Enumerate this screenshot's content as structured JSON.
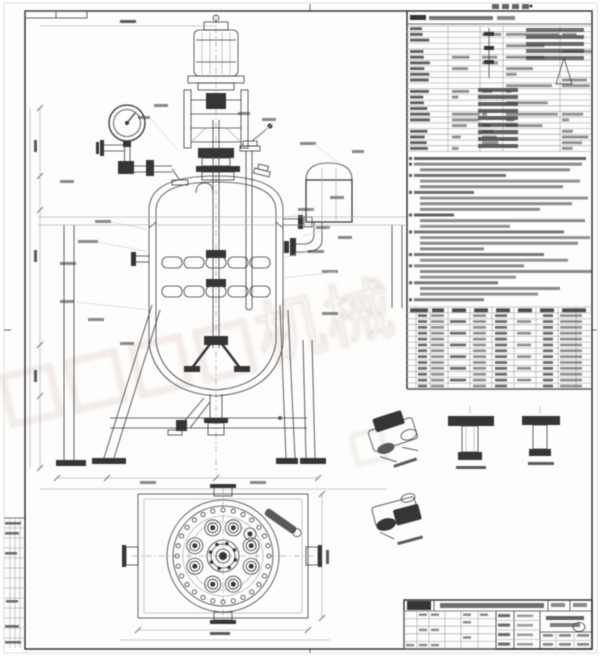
{
  "sheet": {
    "kind": "engineering-drawing",
    "subject": "jacketed stirred reactor vessel, front elevation and plan view with parts list and technical notes"
  },
  "colors": {
    "paper": "#fdfdfc",
    "ink": "#3a3a3a",
    "frame_light": "#c9c9c9",
    "smudge": "#3c3c3c",
    "watermark": "#a5766e"
  },
  "watermark": {
    "text": "□□□□机械",
    "fragment": "□",
    "angle": -13,
    "opacity": 0.4
  },
  "top_stamp": {
    "bar_count": 4
  },
  "right_panel": {
    "x": 407,
    "right": 591,
    "header_underline_y": 24,
    "spec_table": {
      "top": 26,
      "bottom": 152,
      "row_pitch": 5.7,
      "col_x": [
        448,
        480,
        503,
        560
      ]
    },
    "requirements_lines": [
      [
        0,
        172,
        0.8
      ],
      [
        0,
        168,
        0.6
      ],
      [
        6,
        150,
        0.6
      ],
      [
        0,
        92,
        0.72
      ],
      [
        6,
        160,
        0.55
      ],
      [
        6,
        143,
        0.6
      ],
      [
        0,
        60,
        0.75
      ],
      [
        6,
        168,
        0.55
      ],
      [
        6,
        152,
        0.6
      ],
      [
        6,
        120,
        0.6
      ],
      [
        0,
        40,
        0.8
      ],
      [
        6,
        165,
        0.6
      ],
      [
        6,
        90,
        0.55
      ],
      [
        0,
        150,
        0.7
      ],
      [
        6,
        170,
        0.55
      ],
      [
        6,
        158,
        0.6
      ],
      [
        6,
        64,
        0.6
      ],
      [
        0,
        130,
        0.7
      ],
      [
        6,
        148,
        0.55
      ],
      [
        0,
        110,
        0.6
      ],
      [
        6,
        172,
        0.6
      ],
      [
        6,
        96,
        0.55
      ],
      [
        0,
        84,
        0.7
      ],
      [
        6,
        140,
        0.6
      ],
      [
        6,
        118,
        0.55
      ],
      [
        0,
        70,
        0.65
      ]
    ],
    "requirements_top": 157,
    "requirements_pitch": 5.65,
    "parts_table": {
      "top": 307,
      "bottom": 389,
      "rows": 13,
      "col_x": [
        416,
        430,
        448,
        470,
        492,
        514,
        536,
        558,
        576
      ],
      "header_cells": [
        [
          410,
          18
        ],
        [
          432,
          12
        ],
        [
          452,
          14
        ],
        [
          474,
          14
        ],
        [
          496,
          14
        ],
        [
          518,
          14
        ],
        [
          540,
          14
        ],
        [
          562,
          24
        ]
      ],
      "row_cells": [
        [
          418,
          9
        ],
        [
          431,
          13
        ],
        [
          450,
          16
        ],
        [
          473,
          13
        ],
        [
          495,
          12
        ],
        [
          517,
          14
        ],
        [
          543,
          10
        ],
        [
          560,
          22
        ]
      ]
    }
  },
  "front_view": {
    "center_x": 216,
    "leaders": [
      [
        95,
        220,
        16
      ],
      [
        78,
        240,
        20
      ],
      [
        60,
        262,
        16
      ],
      [
        298,
        208,
        16
      ],
      [
        316,
        226,
        14
      ],
      [
        308,
        250,
        16
      ],
      [
        322,
        270,
        16
      ],
      [
        60,
        300,
        14
      ],
      [
        88,
        318,
        16
      ],
      [
        322,
        312,
        16
      ],
      [
        138,
        116,
        12
      ],
      [
        154,
        104,
        14
      ],
      [
        238,
        112,
        12
      ],
      [
        262,
        118,
        14
      ],
      [
        300,
        142,
        16
      ],
      [
        338,
        236,
        14
      ],
      [
        352,
        150,
        12
      ],
      [
        120,
        342,
        14
      ],
      [
        60,
        180,
        14
      ],
      [
        330,
        196,
        14
      ],
      [
        140,
        481,
        16
      ],
      [
        250,
        481,
        16
      ]
    ]
  },
  "plan_view": {
    "cx": 223,
    "cy": 556,
    "flange_radii": [
      56,
      50,
      40,
      34
    ],
    "bolt_circle_r": 46,
    "bolt_count": 28,
    "bolt_r": 2.1,
    "hub_radii": [
      16,
      12
    ],
    "hub_bolt_r": 13,
    "hub_bolt_count": 8,
    "nozzle_r": 30,
    "nozzle_angles": [
      20,
      70,
      110,
      160,
      200,
      250,
      290,
      340
    ]
  },
  "binding_strip": {
    "rows": 13,
    "top": 518,
    "bottom": 648,
    "smudges": [
      [
        5,
        522,
        16
      ],
      [
        5,
        532,
        14
      ],
      [
        5,
        552,
        12
      ],
      [
        6,
        600,
        12
      ],
      [
        5,
        625,
        14
      ],
      [
        5,
        641,
        16
      ]
    ]
  },
  "title_block": {
    "x": 404,
    "y": 600,
    "w": 188,
    "h": 49,
    "rev_cols": [
      404,
      417,
      429,
      445,
      461,
      478,
      496
    ],
    "mid_labels_y": [
      614,
      623.5,
      633,
      642.5
    ],
    "bottom_cells": [
      [
        543,
        634,
        10
      ],
      [
        559,
        634,
        12
      ],
      [
        577,
        634,
        12
      ],
      [
        543,
        643,
        10
      ],
      [
        559,
        643,
        12
      ],
      [
        577,
        643,
        12
      ]
    ]
  }
}
